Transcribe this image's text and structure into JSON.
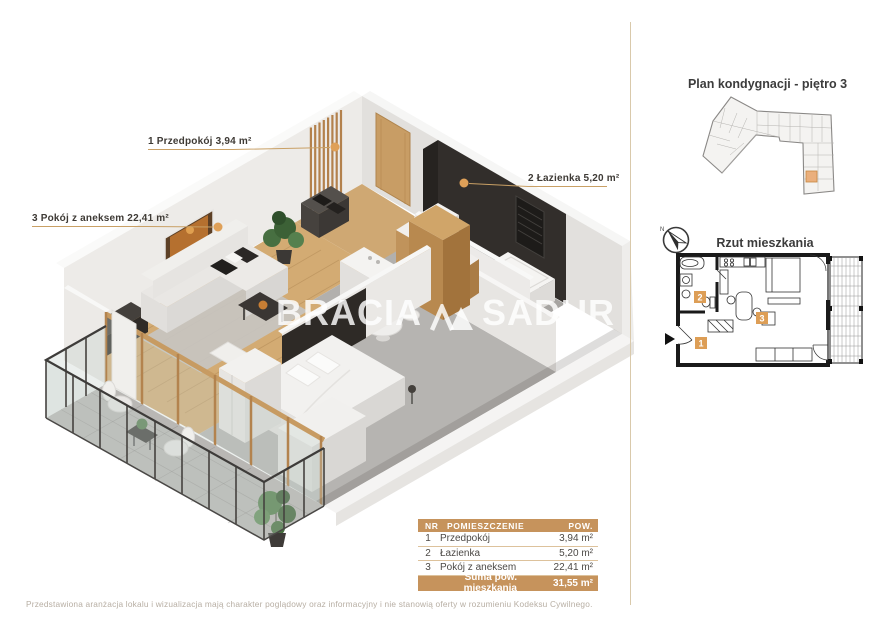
{
  "plan3d": {
    "labels": [
      {
        "text": "1 Przedpokój 3,94 m²"
      },
      {
        "text": "2 Łazienka 5,20 m²"
      },
      {
        "text": "3 Pokój z aneksem 22,41 m²"
      }
    ],
    "watermark": {
      "left": "BRACIA",
      "right": "SADUR"
    }
  },
  "side_panel": {
    "floor_plan_title": "Plan kondygnacji - piętro 3",
    "unit_plan_title": "Rzut mieszkania",
    "compass_label": "N",
    "unit_numbers": [
      "1",
      "2",
      "3"
    ]
  },
  "table": {
    "headers": {
      "nr": "NR",
      "room": "POMIESZCZENIE",
      "area": "POW."
    },
    "rows": [
      {
        "nr": "1",
        "room": "Przedpokój",
        "area": "3,94 m²"
      },
      {
        "nr": "2",
        "room": "Łazienka",
        "area": "5,20 m²"
      },
      {
        "nr": "3",
        "room": "Pokój z aneksem",
        "area": "22,41 m²"
      }
    ],
    "total_label": "Suma pow. mieszkania",
    "total_area": "31,55 m²"
  },
  "footer": {
    "disclaimer": "Przedstawiona aranżacja lokalu i wizualizacja mają charakter poglądowy oraz informacyjny i nie stanowią oferty w rozumieniu Kodeksu Cywilnego."
  },
  "colors": {
    "accent": "#c6935c",
    "leader_dot": "#dfa058",
    "divider": "#d9c9ab"
  }
}
